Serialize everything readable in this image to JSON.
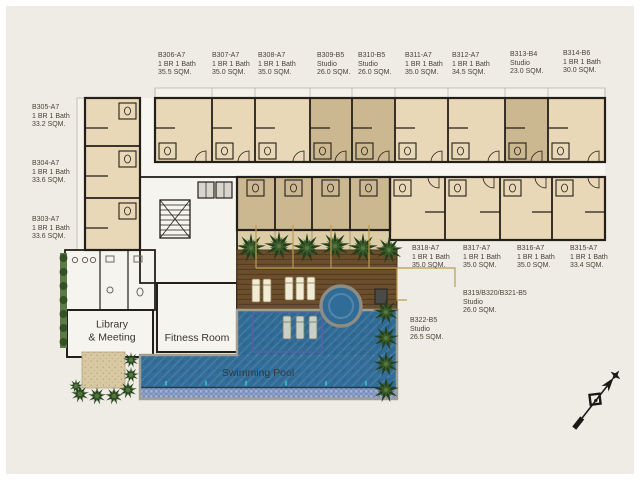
{
  "colors": {
    "bg": "#eeece4",
    "wall": "#241f18",
    "unit_1br": "#e9d8b7",
    "unit_studio": "#cbb790",
    "balcony": "#ddcda7",
    "balcony_light": "#f4f2eb",
    "corridor_fill": "#f8f6f1",
    "room_fill": "#f5f4ef",
    "deck": "#6b4e2b",
    "pool": "#336e99",
    "pool_shelf": "#306b96",
    "spa": "#2f6c97",
    "mosaic_band": "#7b8fbc",
    "coping": "#a29f95",
    "lane_line": "#5c5fa8",
    "tree_dark": "#24401c",
    "tree_mid": "#3b5c2c",
    "tree_light": "#54793f",
    "sand": "#d9c9a2",
    "leader": "#bb9c4f",
    "label_ink": "#4a4437",
    "lounger": "#f2ecd6",
    "spa_ring": "#8e8c83",
    "lift_fill": "#d8d5cf",
    "box_dark": "#4a4a46",
    "teal_marker": "#35c4bb"
  },
  "units": [
    {
      "id": "B306-A7",
      "type": "1 BR 1 Bath",
      "area": "35.5 SQM.",
      "x": 158,
      "y": 52
    },
    {
      "id": "B307-A7",
      "type": "1 BR 1 Bath",
      "area": "35.0 SQM.",
      "x": 212,
      "y": 52
    },
    {
      "id": "B308-A7",
      "type": "1 BR 1 Bath",
      "area": "35.0 SQM.",
      "x": 258,
      "y": 52
    },
    {
      "id": "B309-B5",
      "type": "Studio",
      "area": "26.0 SQM.",
      "x": 317,
      "y": 52
    },
    {
      "id": "B310-B5",
      "type": "Studio",
      "area": "26.0 SQM.",
      "x": 358,
      "y": 52
    },
    {
      "id": "B311-A7",
      "type": "1 BR 1 Bath",
      "area": "35.0 SQM.",
      "x": 405,
      "y": 52
    },
    {
      "id": "B312-A7",
      "type": "1 BR 1 Bath",
      "area": "34.5 SQM.",
      "x": 452,
      "y": 52
    },
    {
      "id": "B313-B4",
      "type": "Studio",
      "area": "23.0 SQM.",
      "x": 510,
      "y": 51
    },
    {
      "id": "B314-B6",
      "type": "1 BR 1 Bath",
      "area": "30.0 SQM.",
      "x": 563,
      "y": 50
    },
    {
      "id": "B305-A7",
      "type": "1 BR 1 Bath",
      "area": "33.2 SQM.",
      "x": 32,
      "y": 104
    },
    {
      "id": "B304-A7",
      "type": "1 BR 1 Bath",
      "area": "33.6 SQM.",
      "x": 32,
      "y": 160
    },
    {
      "id": "B303-A7",
      "type": "1 BR 1 Bath",
      "area": "33.6 SQM.",
      "x": 32,
      "y": 216
    },
    {
      "id": "B318-A7",
      "type": "1 BR 1 Bath",
      "area": "35.0 SQM.",
      "x": 412,
      "y": 245
    },
    {
      "id": "B317-A7",
      "type": "1 BR 1 Bath",
      "area": "35.0 SQM.",
      "x": 463,
      "y": 245
    },
    {
      "id": "B316-A7",
      "type": "1 BR 1 Bath",
      "area": "35.0 SQM.",
      "x": 517,
      "y": 245
    },
    {
      "id": "B315-A7",
      "type": "1 BR 1 Bath",
      "area": "33.4 SQM.",
      "x": 570,
      "y": 245
    },
    {
      "id": "B319/B320/B321-B5",
      "type": "Studio",
      "area": "26.0 SQM.",
      "x": 463,
      "y": 290
    },
    {
      "id": "B322-B5",
      "type": "Studio",
      "area": "26.5 SQM.",
      "x": 410,
      "y": 317
    }
  ],
  "amenities": {
    "library_1": "Library",
    "library_2": "& Meeting",
    "fitness": "Fitness Room",
    "pool": "Swimming Pool"
  },
  "icons": {
    "compass": "north-arrow"
  }
}
